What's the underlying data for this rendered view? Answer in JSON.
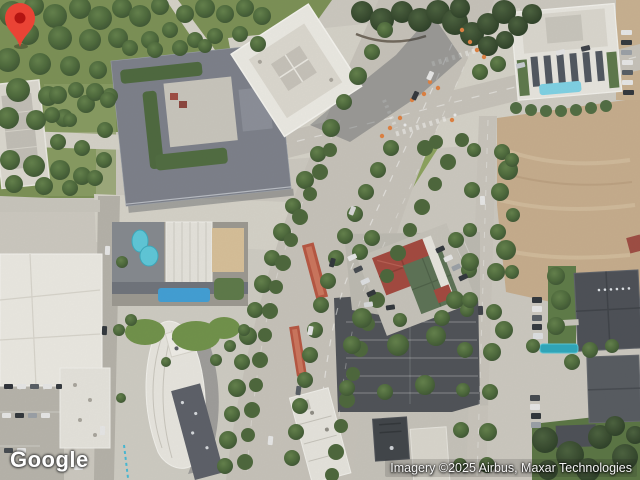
{
  "map": {
    "kind": "satellite",
    "branding": {
      "logo_text": "Google"
    },
    "attribution": {
      "text": "Imagery ©2025 Airbus, Maxar Technologies"
    },
    "marker": {
      "fill": "#EA4335",
      "dot": "#B31412",
      "shape": "map-pin"
    },
    "palette": {
      "ground": "#cdc9c0",
      "road": "#c7c3ba",
      "plaza": "#d6d3c9",
      "grass": "#7a9053",
      "tree_dark": "#3a5432",
      "tree_light": "#5e7b47",
      "dirt_lot": "#c7ad8c",
      "parking_asphalt": "#4d5055",
      "roof_white": "#eceae3",
      "roof_slate": "#7b7f89",
      "roof_red": "#a3463c",
      "roof_green": "#5a7153",
      "pool_blue": "#5cc8da",
      "canopy_blue": "#3f9fd6",
      "transit_platform": "#b7543f",
      "construction_orange": "#e0803f"
    }
  }
}
